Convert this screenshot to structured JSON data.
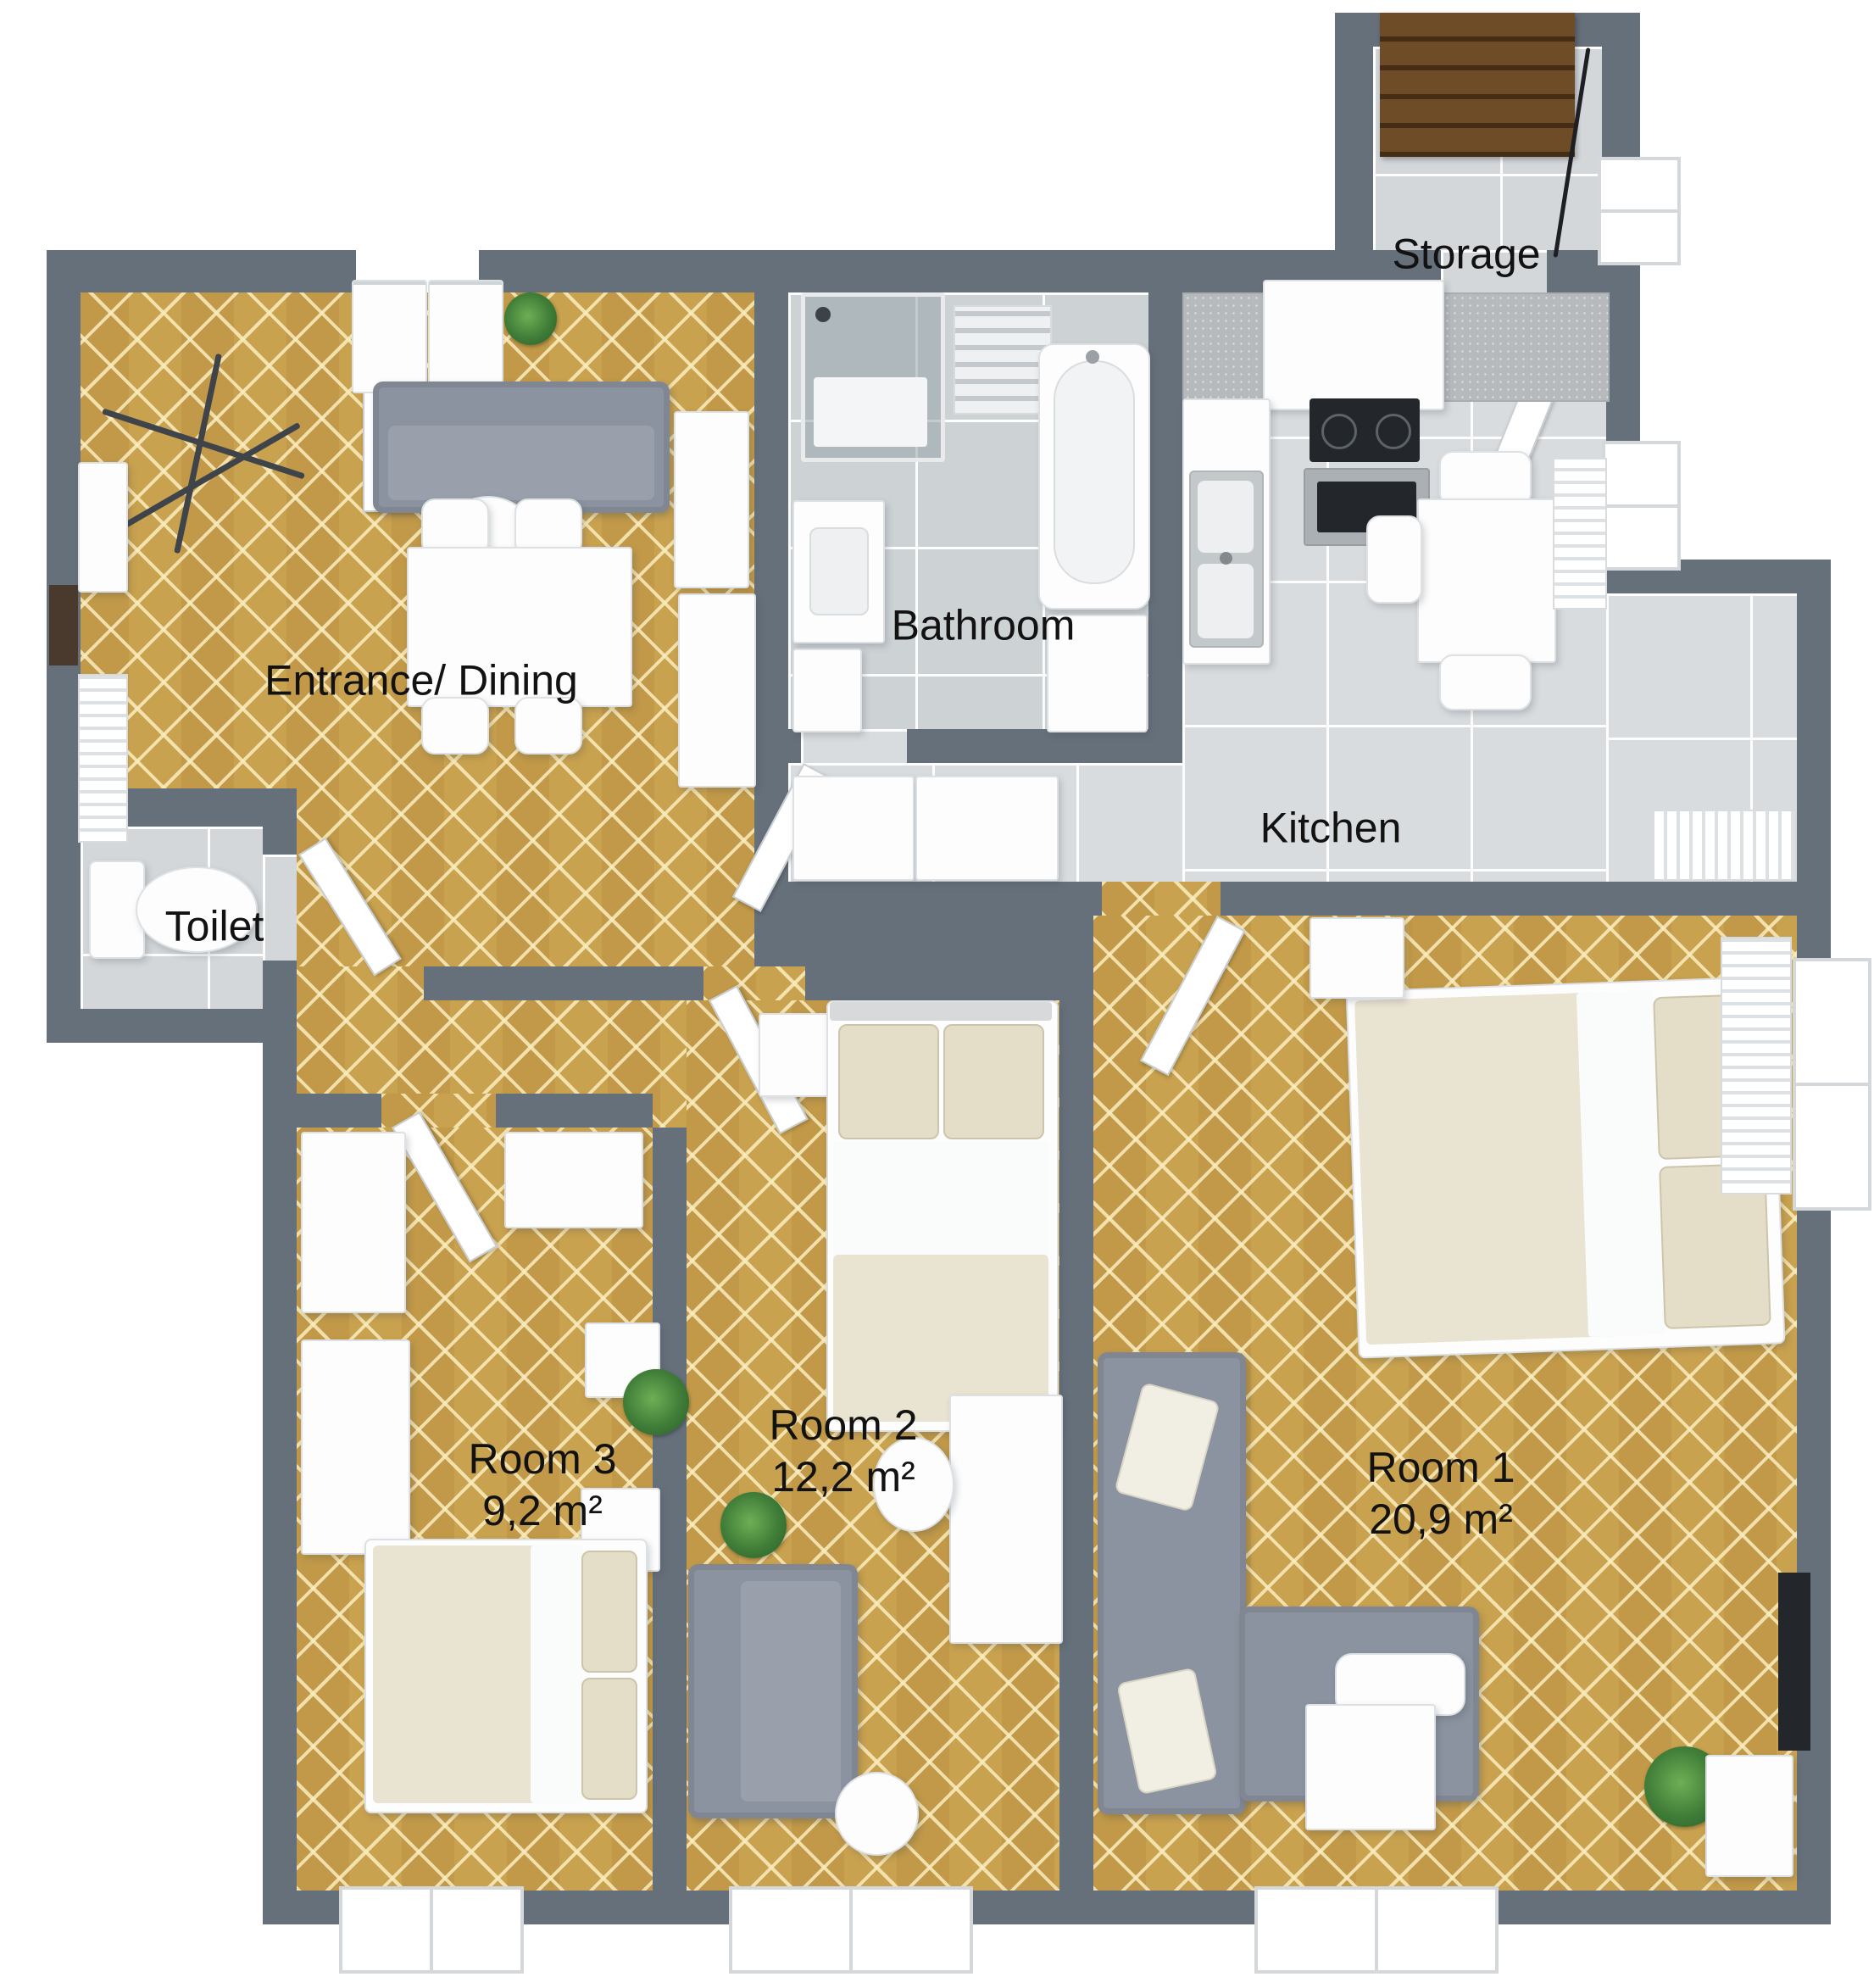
{
  "rooms": {
    "entrance": {
      "label": "Entrance/ Dining"
    },
    "bathroom": {
      "label": "Bathroom"
    },
    "kitchen": {
      "label": "Kitchen"
    },
    "storage": {
      "label": "Storage"
    },
    "toilet": {
      "label": "Toilet"
    },
    "room1": {
      "label": "Room 1",
      "area": "20,9 m²"
    },
    "room2": {
      "label": "Room 2",
      "area": "12,2 m²"
    },
    "room3": {
      "label": "Room 3",
      "area": "9,2 m²"
    }
  },
  "colors": {
    "wall": "#66707a",
    "wood_floor": "#c9a24f",
    "tile_bathroom": "#cdd2d5",
    "tile_kitchen": "#d9dcde",
    "tile_generic": "#d3d7d9",
    "sofa_fabric": "#8b93a0",
    "bed_linen": "#e9e3d2",
    "stairs_wood": "#6f4c28",
    "label_text": "#121212",
    "background": "#ffffff"
  }
}
